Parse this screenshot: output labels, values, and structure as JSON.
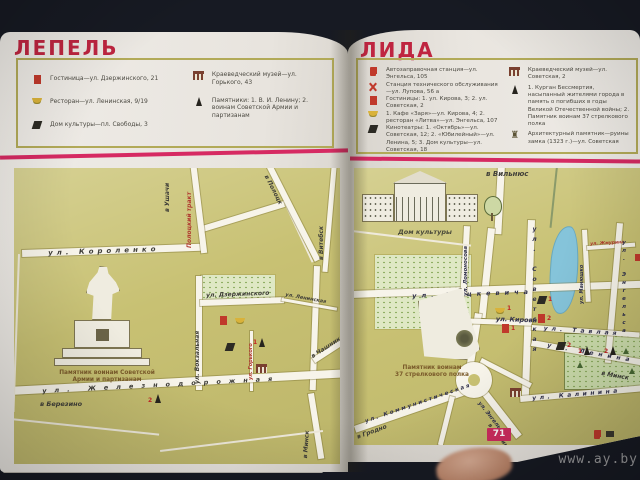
{
  "photo": {
    "watermark": "www.ay.by"
  },
  "left_page": {
    "title": "ЛЕПЕЛЬ",
    "legend": {
      "items": [
        {
          "icon": "hotel-icon",
          "text": "Гостиница—ул. Дзержинского, 21"
        },
        {
          "icon": "restaurant-icon",
          "text": "Ресторан—ул. Ленинская, 9/19"
        },
        {
          "icon": "culture-house-icon",
          "text": "Дом культуры—пл. Свободы, 3"
        },
        {
          "icon": "museum-icon",
          "text": "Краеведческий музей—ул. Горького, 43"
        },
        {
          "icon": "monument-icon",
          "text": "Памятники: 1. В. И. Ленину; 2. воинам Советской Армии и партизанам"
        }
      ]
    },
    "map": {
      "labels": {
        "korolenko": "ул. Короленко",
        "ushachi": "в Ушачи",
        "polotsky_trakt": "Полоцкий тракт",
        "polotsk": "в Полоцк",
        "vitebsk": "в Витебск",
        "dzerzhinskogo": "ул. Дзержинского",
        "leninskaya": "ул. Ленинская",
        "vokzalnaya": "ул. Вокзальная",
        "gorkogo": "ул. Горького",
        "zheleznodorozhnaya": "ул. Железнодорожная",
        "berezino": "в Березино",
        "chashniki": "в Чашники",
        "minsk": "в Минск"
      },
      "monument_caption": {
        "line1": "Памятник воинам Советской",
        "line2": "Армии и партизанам"
      },
      "markers": {
        "lenin_no": "1",
        "war_no": "2"
      }
    }
  },
  "right_page": {
    "title": "ЛИДА",
    "legend": {
      "items": [
        {
          "icon": "fuel-station-icon",
          "text": "Автозаправочная станция—ул. Энгельса, 105"
        },
        {
          "icon": "car-service-icon",
          "text": "Станция технического обслуживания—ул. Лупова, 56 а"
        },
        {
          "icon": "hotel-icon",
          "text": "Гостиницы: 1. ул. Кирова, 3; 2. ул. Советская, 2"
        },
        {
          "icon": "restaurant-icon",
          "text": "1. Кафе «Заря»—ул. Кирова, 4; 2. ресторан «Литва»—ул. Энгельса, 107"
        },
        {
          "icon": "cinema-icon",
          "text": "Кинотеатры: 1. «Октябрь»—ул. Советская, 12; 2. «Юбилейный»—ул. Ленина, 5; 3. Дом культуры—ул. Советская, 18"
        },
        {
          "icon": "museum-icon",
          "text": "Краеведческий музей—ул. Советская, 2"
        },
        {
          "icon": "monument-icon",
          "text": "1. Курган Бессмертия, насыпанный жителями города в память о погибших в годы Великой Отечественной войны; 2. Памятник воинам 37 стрелкового полка"
        },
        {
          "icon": "castle-icon",
          "text": "Архитектурный памятник—руины замка (1323 г.)—ул. Советская"
        }
      ]
    },
    "map": {
      "labels": {
        "vilnius": "в Вильнюс",
        "dom_kultury": "Дом культуры",
        "lomonosova": "ул. Ломоносова",
        "mickiewicza": "ул. Мицкевича",
        "sovetskaya": "ул. Советская",
        "kirova": "ул. Кирова",
        "manyushko": "ул. Манюшко",
        "zhmurina": "ул. Жмурина",
        "engelsa_east": "ул. Энгельса",
        "tavlaya": "ул. Тавлая",
        "lenina": "ул. Ленина",
        "minsk": "в Минск",
        "kalinina": "ул. Калинина",
        "kommunisticheskaya": "ул. Коммунистическая",
        "grodno": "в Гродно",
        "engelsa_south": "ул. Энгельса",
        "slonim": "в Слоним"
      },
      "monument_caption": {
        "line1": "Памятник воинам",
        "line2": "37 стрелкового полка"
      },
      "page_number": "71",
      "markers": {
        "park1": "1",
        "park2": "2",
        "hotel1": "1",
        "hotel2": "2",
        "cafe1": "1",
        "cinema1": "1",
        "cinema2": "2"
      }
    }
  }
}
